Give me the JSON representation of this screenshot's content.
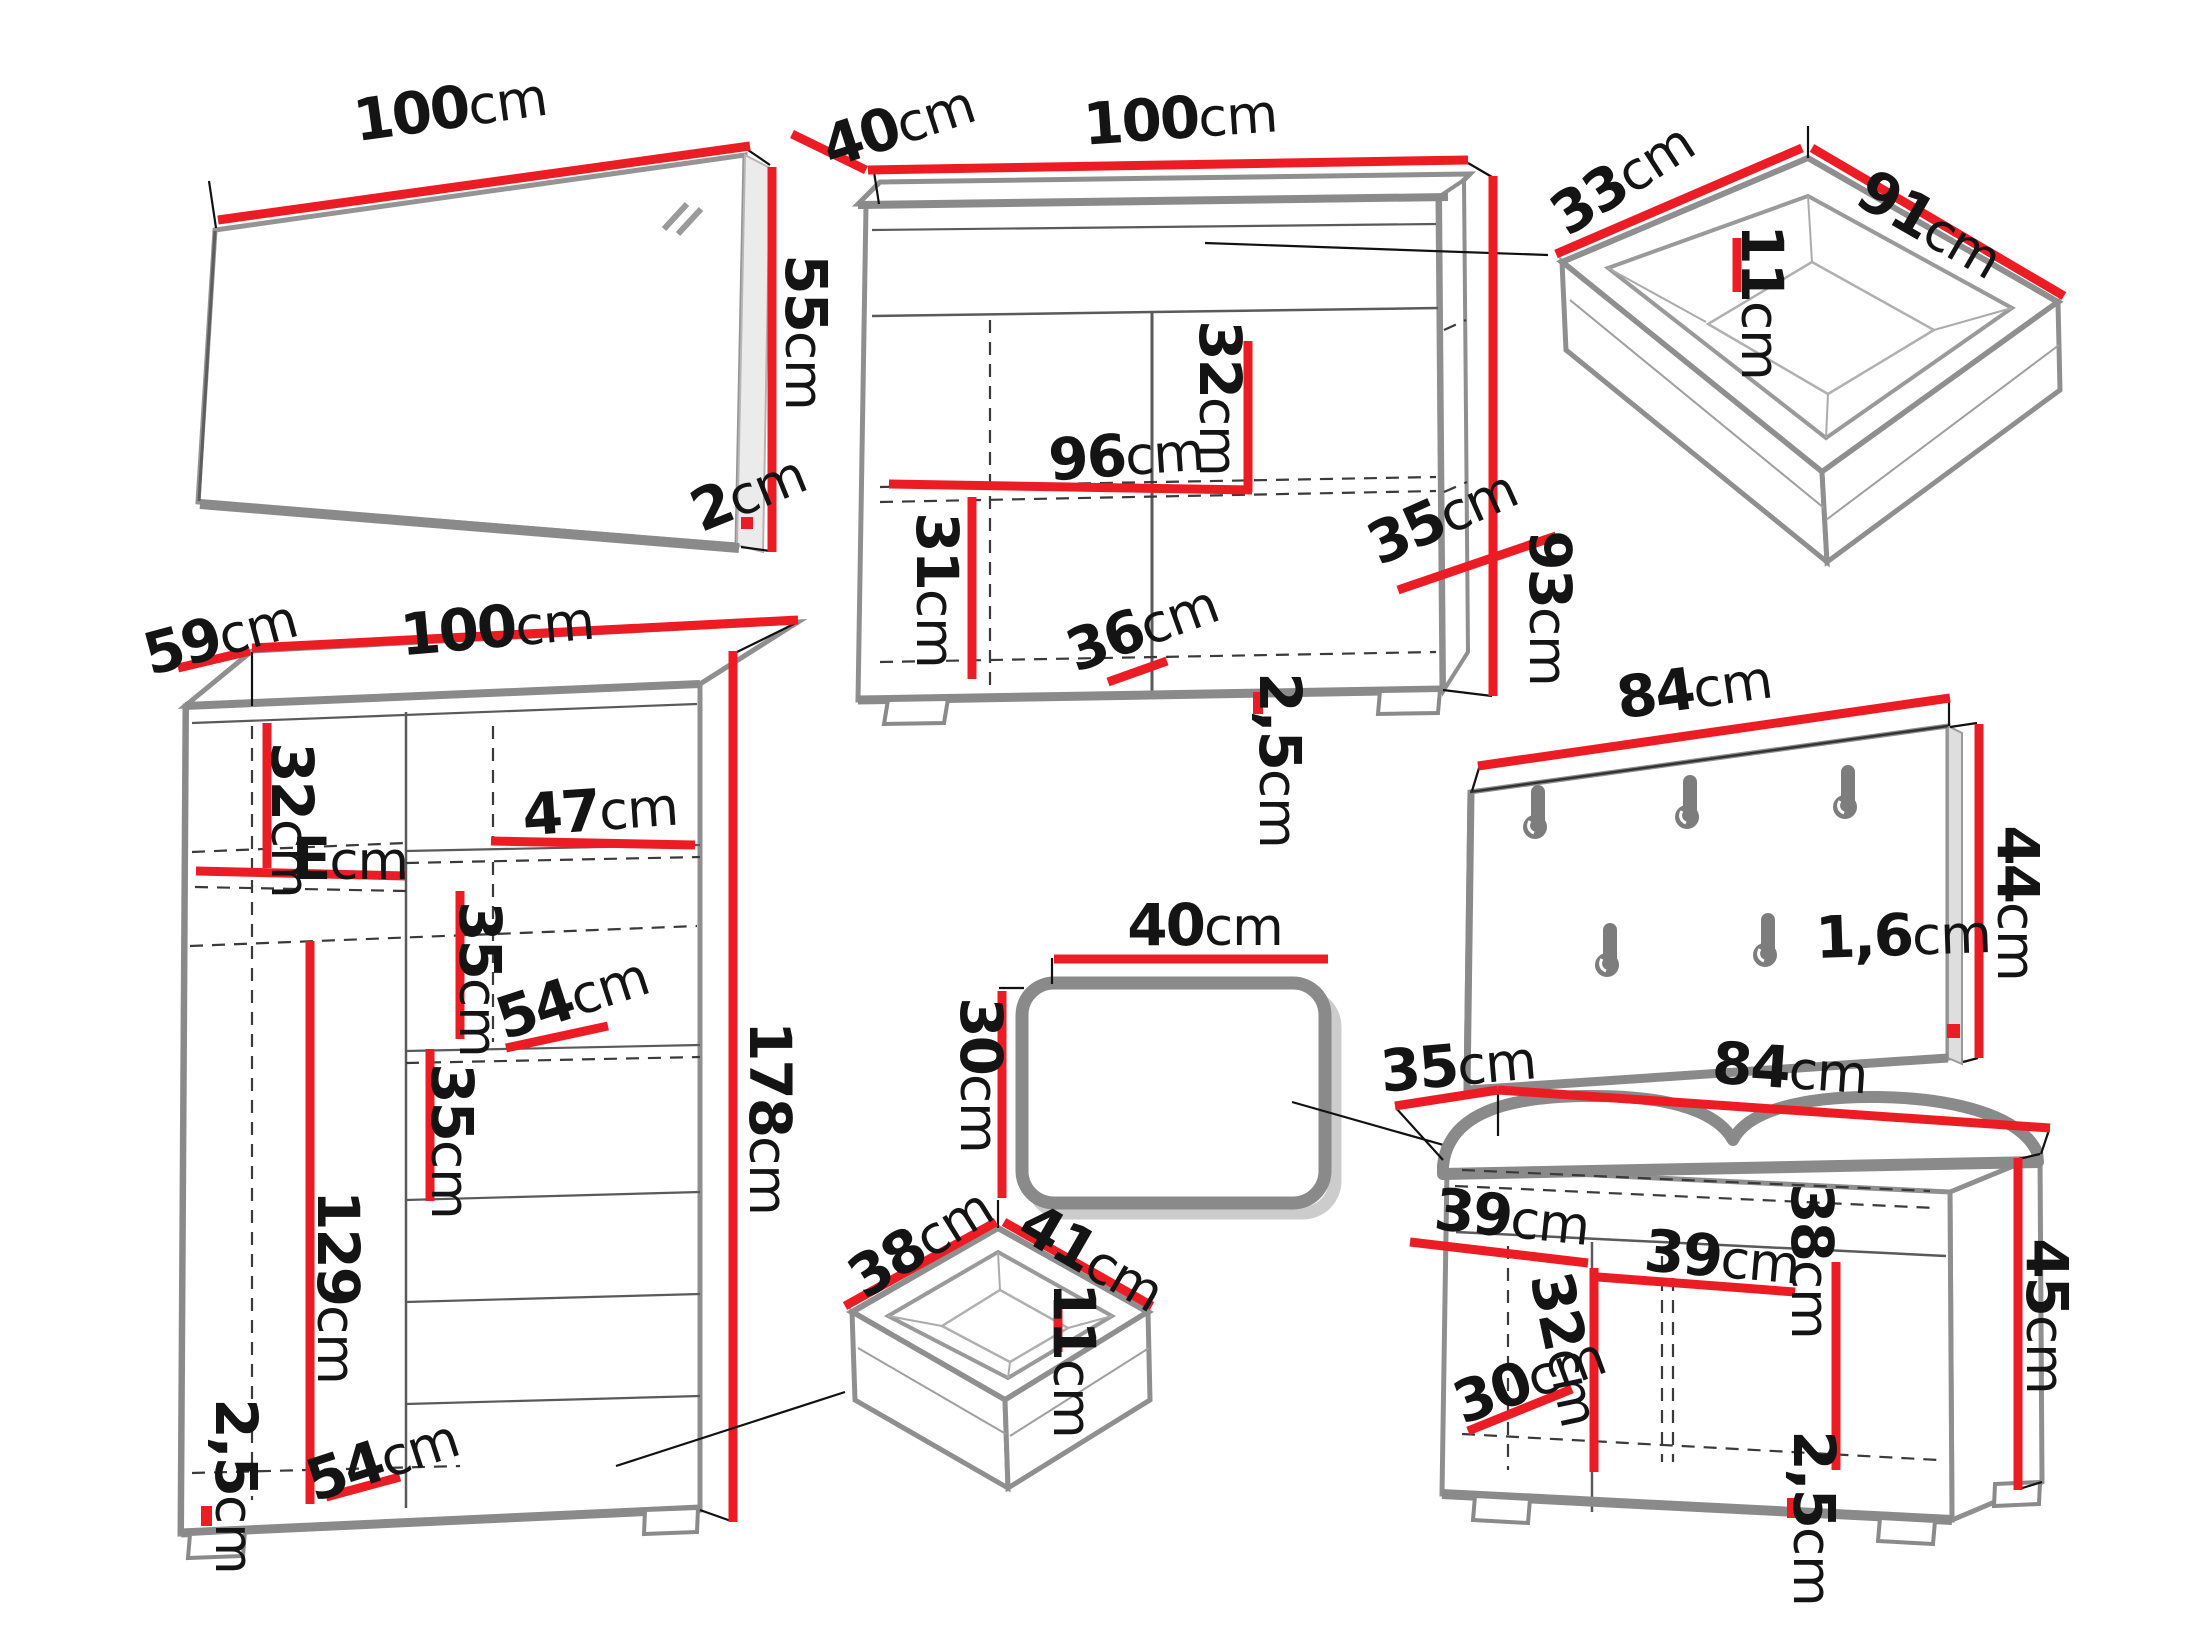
{
  "unit": "cm",
  "colors": {
    "dimension_red": "#ec1c24",
    "furniture_gray": "#8a8a8a",
    "text_black": "#141414"
  },
  "items": {
    "mirror": {
      "width": "100",
      "height": "55",
      "depth": "2"
    },
    "cabinet": {
      "depth": "40",
      "width": "100",
      "inner_width": "96",
      "shelf_top": "32",
      "shelf_bottom": "31",
      "inner_depth": "36",
      "side_depth": "35",
      "height": "93",
      "plinth": "2,5"
    },
    "drawer_large": {
      "depth": "33",
      "width": "91",
      "height": "11"
    },
    "coat_rack": {
      "width": "84",
      "height": "44",
      "thickness": "1,6"
    },
    "wardrobe": {
      "depth": "59",
      "width": "100",
      "top_shelf": "32",
      "shelf_depth": "E",
      "shelf_width": "47",
      "section_a": "35",
      "shelf_diag": "54",
      "section_b": "35",
      "door_height": "129",
      "height": "178",
      "bottom_diag": "54",
      "plinth": "2,5"
    },
    "stool": {
      "width": "40",
      "height": "30"
    },
    "drawer_small": {
      "depth": "38",
      "width": "41",
      "height": "11"
    },
    "bench": {
      "depth": "35",
      "width": "84",
      "left_inner": "39",
      "right_inner": "39",
      "divider": "32",
      "inner_height": "38",
      "bottom_depth": "30",
      "height": "45",
      "plinth": "2,5"
    }
  }
}
